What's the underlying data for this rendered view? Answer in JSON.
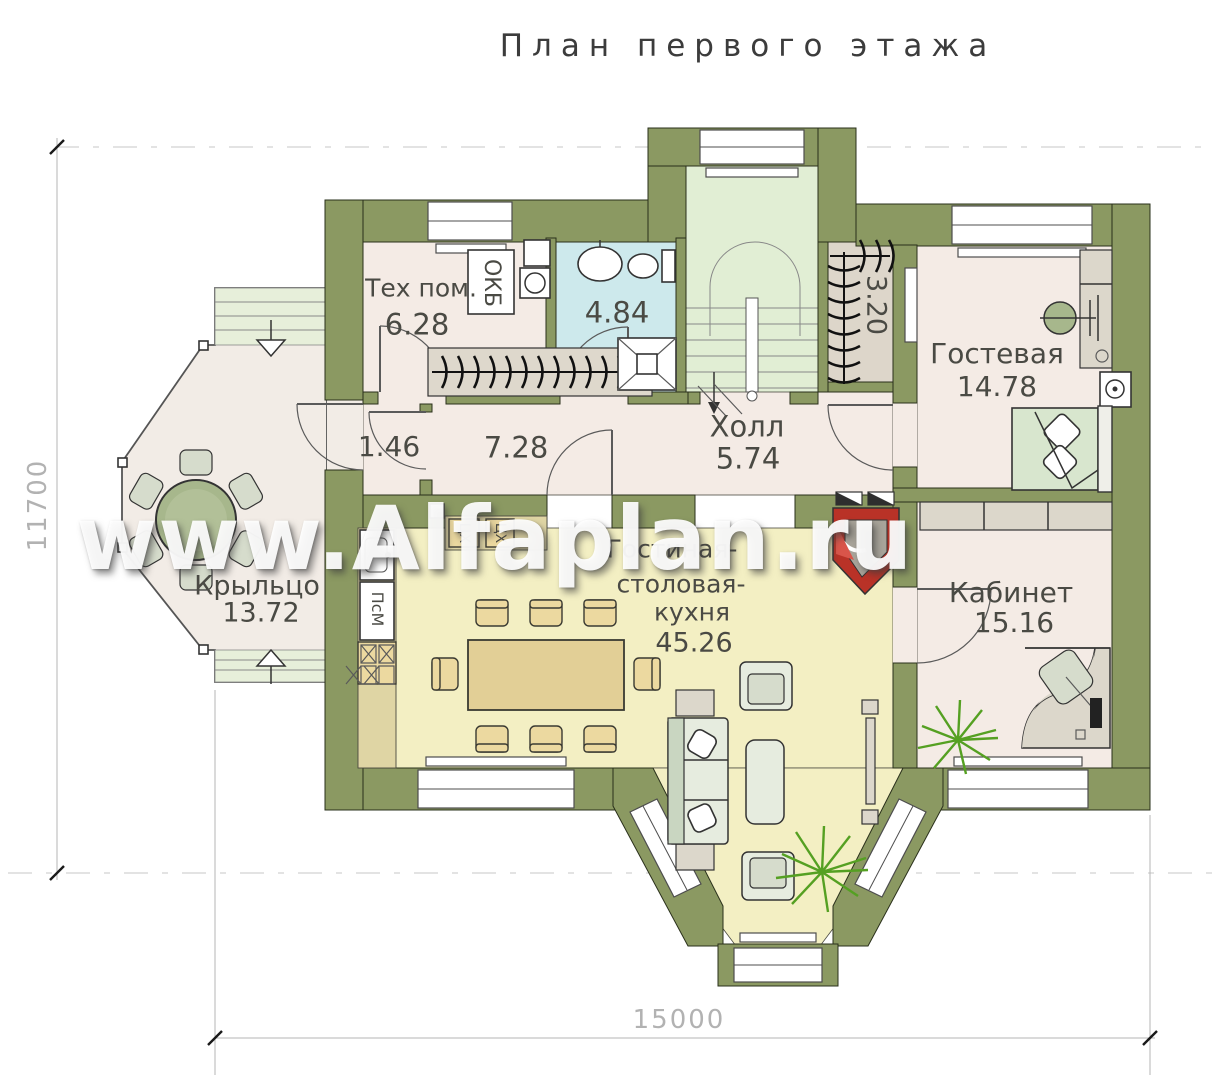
{
  "title": "План первого этажа",
  "watermark": "www.Alfaplan.ru",
  "dimensions": {
    "height_mm": "11700",
    "width_mm": "15000"
  },
  "rooms": {
    "tech": {
      "name": "Тех пом.",
      "area": "6.28"
    },
    "bathroom": {
      "area": "4.84"
    },
    "hall": {
      "name": "Холл",
      "area": "5.74"
    },
    "wardrobe": {
      "area": "3.20"
    },
    "guest": {
      "name": "Гостевая",
      "area": "14.78"
    },
    "entry": {
      "area": "1.46"
    },
    "corridor": {
      "area": "7.28"
    },
    "porch": {
      "name": "Крыльцо",
      "area": "13.72"
    },
    "living": {
      "name_line1": "Гостиная-",
      "name_line2": "столовая-",
      "name_line3": "кухня",
      "area": "45.26"
    },
    "office": {
      "name": "Кабинет",
      "area": "15.16"
    }
  },
  "equipment": {
    "boiler": "ОКБ",
    "dishwasher": "ПсМ",
    "fridge1": "ЦХ",
    "fridge2": "ЦХ"
  },
  "colors": {
    "wall_olive": "#8b9962",
    "floor_pink": "#f4ebe5",
    "floor_blue": "#cde9ec",
    "floor_stairs": "#e1eed4",
    "floor_living": "#f3efc3",
    "fireplace_red": "#b93227",
    "plant_green": "#55a022"
  }
}
